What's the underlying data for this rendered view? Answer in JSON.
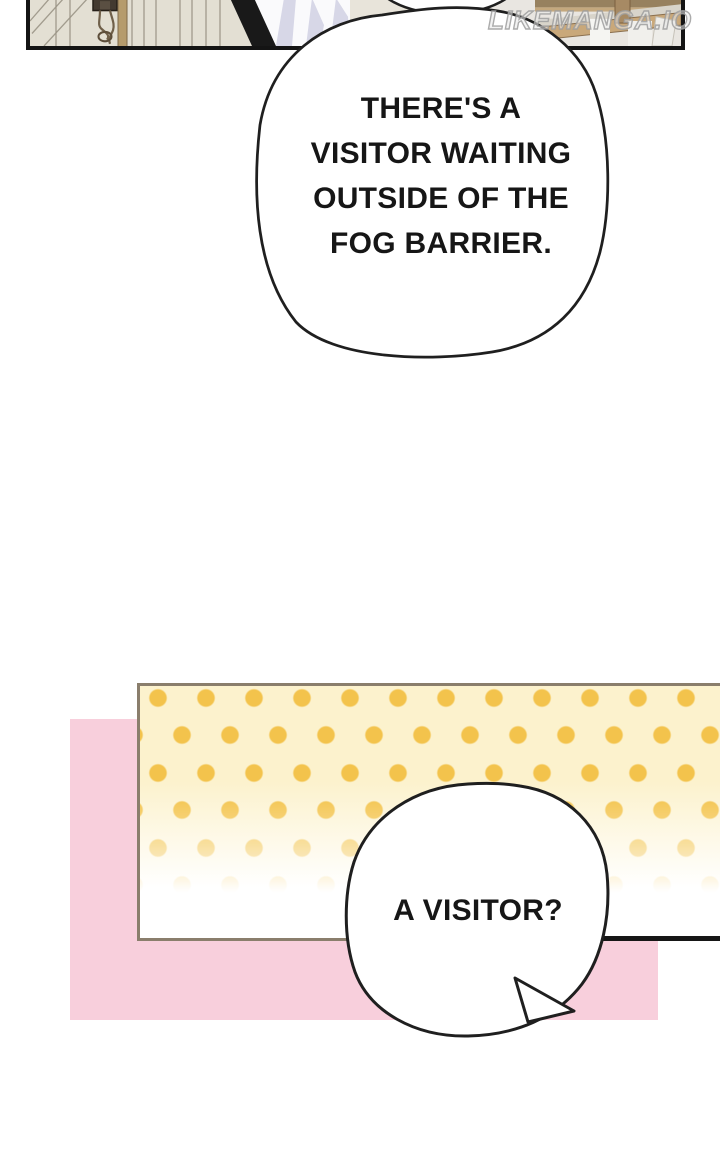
{
  "watermark": {
    "text": "LIKEMANGA.IO"
  },
  "speech": {
    "bubble1": {
      "line1": "THERE'S A",
      "line2": "VISITOR WAITING",
      "line3": "OUTSIDE OF THE",
      "line4": "FOG BARRIER."
    },
    "bubble2": {
      "text": "A VISITOR?"
    }
  },
  "colors": {
    "ink": "#161616",
    "pink_block": "#f8cfdc",
    "dot_gold": "#f3c34c",
    "dot_panel_bg": "#fcf2cd",
    "dot_panel_border": "#8a7e6c",
    "wood_tan": "#c9a87a",
    "door_beige": "#e3dfd3",
    "cloth_lavender": "#d7d7e7"
  }
}
